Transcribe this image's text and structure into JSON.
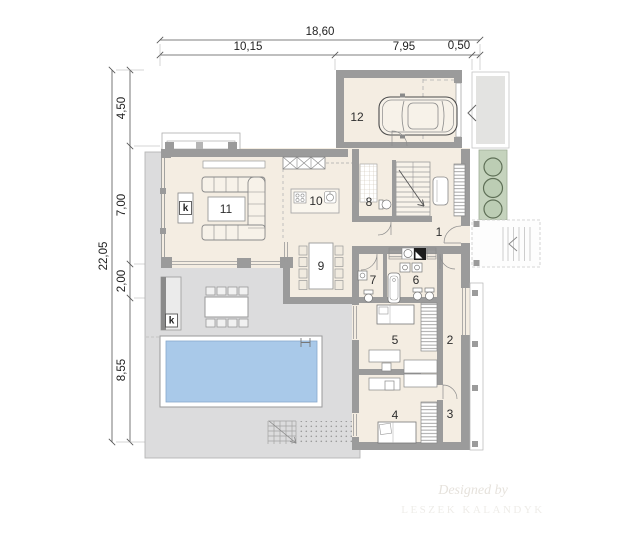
{
  "plan": {
    "dim_top": {
      "total": "18,60",
      "seg1": "10,15",
      "seg2": "7,95",
      "seg3": "0,50"
    },
    "dim_left": {
      "total": "22,05",
      "seg1": "4,50",
      "seg2": "7,00",
      "seg3": "2,00",
      "seg4": "8,55"
    },
    "rooms": {
      "hall": "1",
      "corridor": "2",
      "wardrobe": "3",
      "bedroom_2": "4",
      "bedroom_1": "5",
      "bathroom": "6",
      "wc": "7",
      "shower_room": "8",
      "dining": "9",
      "kitchen": "10",
      "living": "11",
      "garage": "12"
    },
    "markers": {
      "fireplace": "k",
      "outdoor_fireplace": "k"
    },
    "watermark": {
      "line1": "Designed by",
      "line2": "LESZEK KALANDYK"
    },
    "colors": {
      "wall": "#9b9b9b",
      "floor": "#f4ede2",
      "terrace": "#dcdcdd",
      "pool_water": "#a9c9e9",
      "greenery": "#c5d3bd",
      "paving": "#e3e3e1"
    }
  }
}
